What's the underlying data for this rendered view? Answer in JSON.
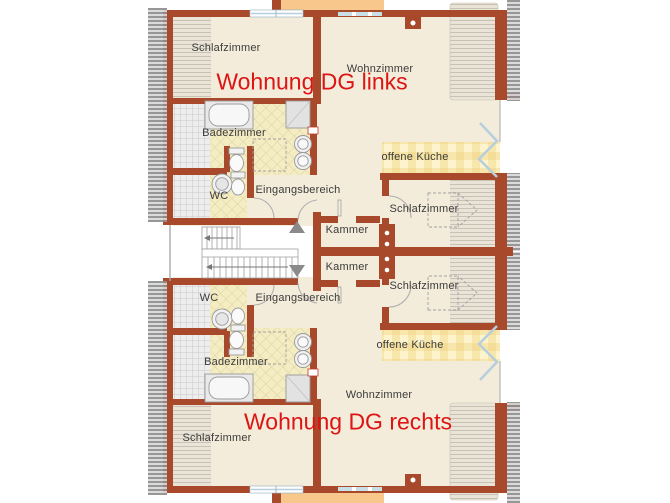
{
  "plan": {
    "type": "attic floor plan, two mirrored apartments around central staircase",
    "colors": {
      "wall": "#a8492c",
      "floor": "#f4ecda",
      "accent_text": "#dd1414",
      "bath_tile": "#f4ecc3",
      "kitchen_tile": "#f7e7ac",
      "adjacent_area_orange": "#f8c78c",
      "roof_hatch_gray": "#8f8f8f",
      "window_glass": "#b7cedc"
    },
    "apartments": {
      "left": {
        "title": "Wohnung DG links",
        "rooms": {
          "schlafzimmer_left": "Schlafzimmer",
          "wohnzimmer": "Wohnzimmer",
          "badezimmer": "Badezimmer",
          "wc": "WC",
          "eingangsbereich": "Eingangsbereich",
          "kueche": "offene Küche",
          "schlafzimmer_right": "Schlafzimmer",
          "kammer": "Kammer"
        }
      },
      "right": {
        "title": "Wohnung DG rechts",
        "rooms": {
          "schlafzimmer_left": "Schlafzimmer",
          "wohnzimmer": "Wohnzimmer",
          "badezimmer": "Badezimmer",
          "wc": "WC",
          "eingangsbereich": "Eingangsbereich",
          "kueche": "offene Küche",
          "schlafzimmer_right": "Schlafzimmer",
          "kammer": "Kammer"
        }
      }
    }
  }
}
